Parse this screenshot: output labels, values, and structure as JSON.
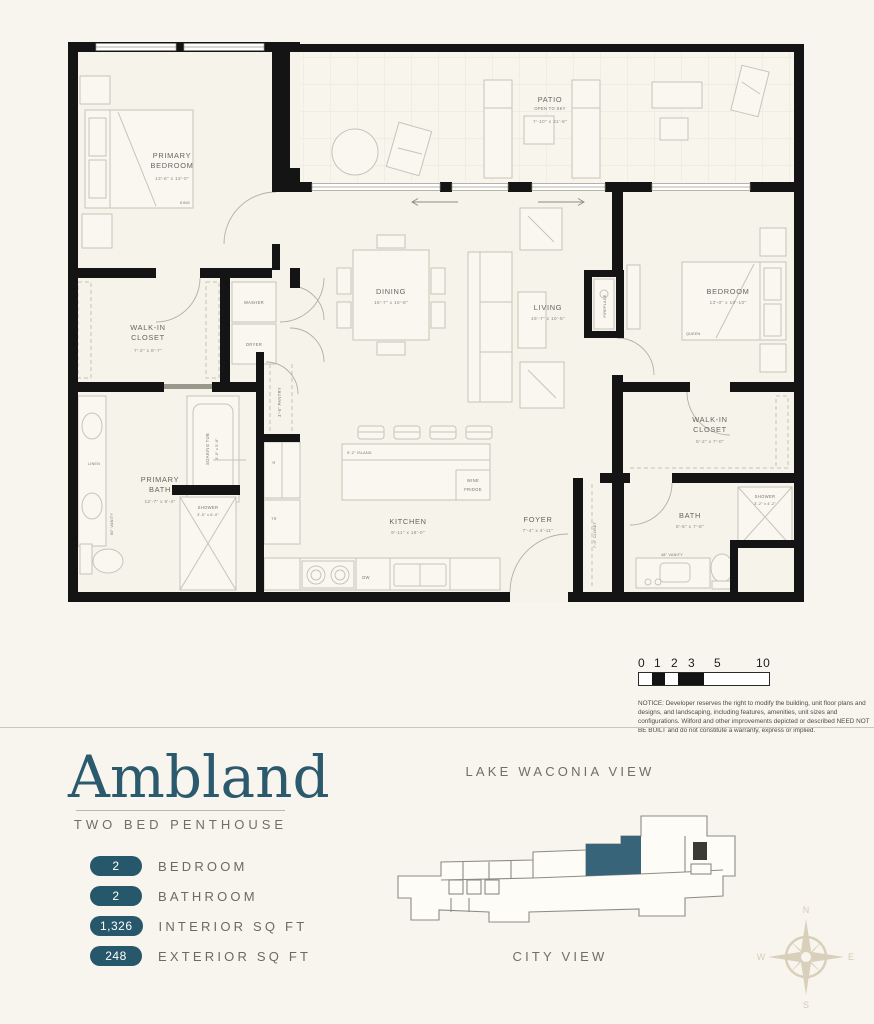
{
  "branding": {
    "title": "Ambland",
    "subtitle": "TWO BED PENTHOUSE"
  },
  "stats": [
    {
      "value": "2",
      "label": "BEDROOM"
    },
    {
      "value": "2",
      "label": "BATHROOM"
    },
    {
      "value": "1,326",
      "label": "INTERIOR SQ FT"
    },
    {
      "value": "248",
      "label": "EXTERIOR SQ FT"
    }
  ],
  "views": {
    "top": "LAKE WACONIA VIEW",
    "bottom": "CITY VIEW"
  },
  "compass": {
    "n": "N",
    "s": "S",
    "e": "E",
    "w": "W"
  },
  "scale": {
    "t0": "0",
    "t1": "1",
    "t2": "2",
    "t3": "3",
    "t5": "5",
    "t10": "10"
  },
  "notice": "NOTICE: Developer reserves the right to modify the building, unit floor plans and designs, and landscaping, including features, amenities, unit sizes and configurations. Wilford and other improvements depicted or described NEED NOT BE BUILT and do not constitute a warranty, express or implied.",
  "rooms": {
    "patio": {
      "l1": "PATIO",
      "l2": "OPEN TO SKY",
      "dims": "7'-10\" x 31'-8\""
    },
    "primary_bedroom": {
      "l1": "PRIMARY",
      "l2": "BEDROOM",
      "dims": "13'-6\" x 13'-0\"",
      "bed": "KING"
    },
    "walk_in_closet_a": {
      "l1": "WALK-IN",
      "l2": "CLOSET",
      "dims": "7'-2\" x 8'-7\""
    },
    "primary_bath": {
      "l1": "PRIMARY",
      "l2": "BATH",
      "dims": "12'-7\" x 6'-4\""
    },
    "dining": {
      "l1": "DINING",
      "dims": "15'-7\" x 10'-8\""
    },
    "living": {
      "l1": "LIVING",
      "dims": "15'-7\" x 10'-5\""
    },
    "kitchen": {
      "l1": "KITCHEN",
      "dims": "9'-11\" x 16'-0\""
    },
    "foyer": {
      "l1": "FOYER",
      "dims": "7'-4\" x 4'-11\""
    },
    "bedroom": {
      "l1": "BEDROOM",
      "dims": "13'-0\" x 10'-10\"",
      "bed": "QUEEN"
    },
    "walk_in_closet_b": {
      "l1": "WALK-IN",
      "l2": "CLOSET",
      "dims": "5'-2\" x 7'-0\""
    },
    "bath": {
      "l1": "BATH",
      "dims": "6'-5\" x 7'-8\""
    }
  },
  "fixtures": {
    "washer": "WASHER",
    "dryer": "DRYER",
    "soaking_tub": "SOAKING TUB",
    "soaking_tub_dims": "3'-0\" x 5'-6\"",
    "shower_primary": "SHOWER",
    "shower_primary_dims": "3'-5\" x 6'-0\"",
    "shower_b": "SHOWER",
    "shower_b_dims": "3'-2\" x 4'-2\"",
    "pantry": "3'-6\" PANTRY",
    "island": "9'-2\" ISLAND",
    "wine_l1": "WINE",
    "wine_l2": "FRIDGE",
    "dw": "DW",
    "linen": "LINEN",
    "vanity60": "60\" VANITY",
    "vanity48": "48\" VANITY",
    "closet7": "7'-0\" CLOSET",
    "fireplace": "FIREPLACE",
    "fridge": "R",
    "trash": "TR"
  },
  "colors": {
    "accent": "#2b5a6e",
    "wall": "#141414",
    "background": "#f8f5ee",
    "keyplan_highlight": "#38647a"
  }
}
